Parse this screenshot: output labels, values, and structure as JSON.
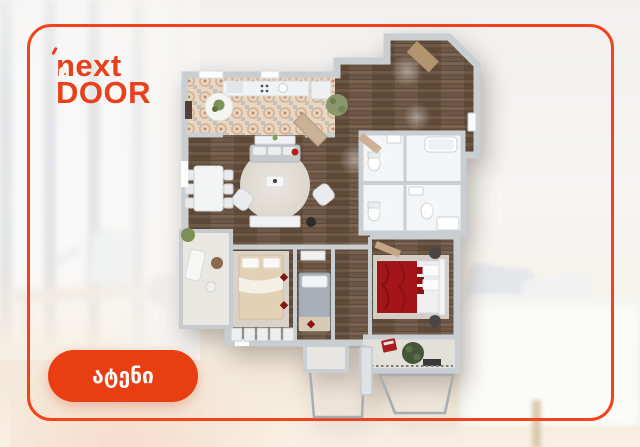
{
  "brand": {
    "line1": "next",
    "line2": "DOOR"
  },
  "badge": {
    "label": "ატენი"
  },
  "palette": {
    "accent_border": "#F4421B",
    "badge_bg": "#E93D12",
    "badge_text": "#FFFFFF",
    "logo": "#E8401A"
  },
  "floorplan": {
    "type": "3d-render-top-view",
    "rooms": [
      "entry-hall",
      "kitchen",
      "dining-area",
      "living-room",
      "bathroom-1",
      "bathroom-2",
      "bedroom-1",
      "bedroom-2",
      "bedroom-3",
      "balcony-left",
      "balcony-center",
      "terrace-right"
    ],
    "floor_colors": {
      "wood": "#6D5745",
      "tile": "#E7D7C3",
      "walls": "#C9CED3",
      "bathroom": "#F3F5F6"
    }
  }
}
